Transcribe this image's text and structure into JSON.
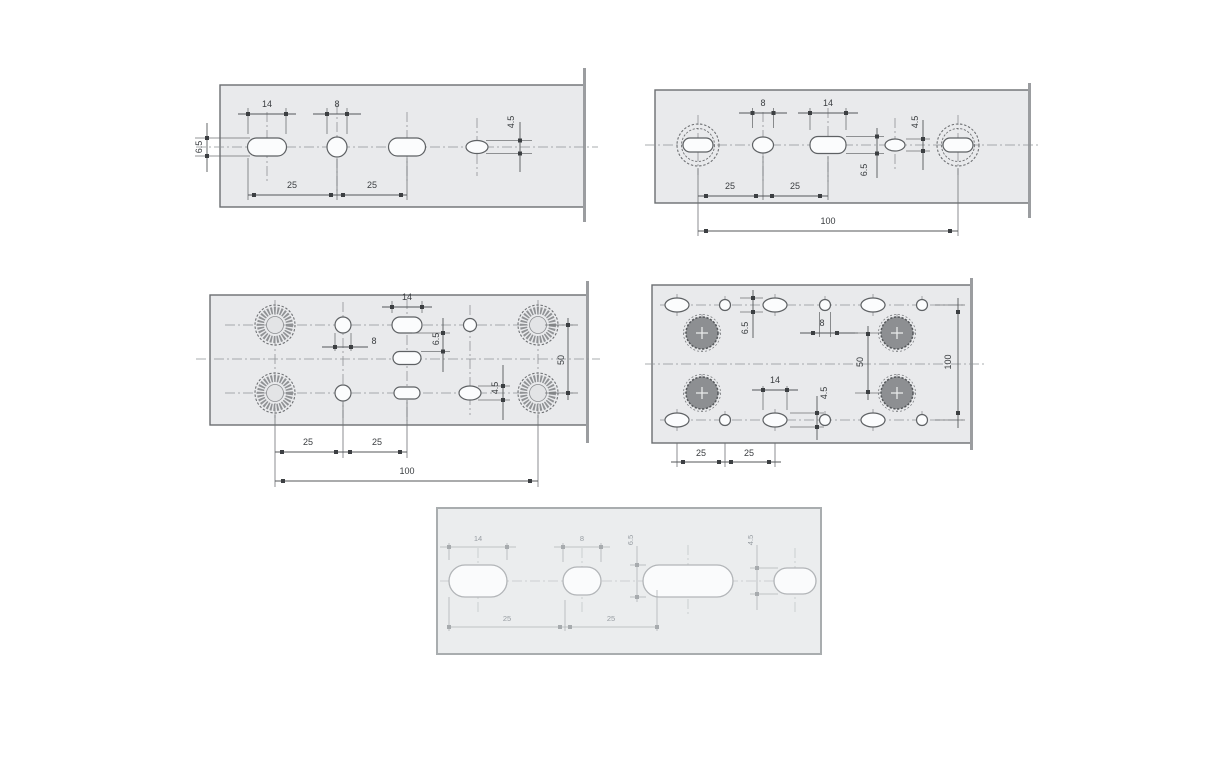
{
  "palette": {
    "plate_fill": "#e9eaec",
    "line_color": "#54575a",
    "faint_line_color": "#b0b3b6",
    "dark_hole_fill": "#8d8f92"
  },
  "drawings": {
    "a": {
      "slot_width": "14",
      "hole_width": "8",
      "slot_height": "6.5",
      "oval_height": "4.5",
      "pitch1": "25",
      "pitch2": "25"
    },
    "b": {
      "hole_width": "8",
      "slot_width": "14",
      "slot_height": "6.5",
      "oval_height": "4.5",
      "pitch1": "25",
      "pitch2": "25",
      "overall_length": "100"
    },
    "c": {
      "slot_width": "14",
      "hole_width": "8",
      "slot_height": "6.5",
      "oval_height": "4.5",
      "row_spacing": "50",
      "pitch1": "25",
      "pitch2": "25",
      "overall_length": "100"
    },
    "d": {
      "slot_height": "6.5",
      "hole_width": "8",
      "row_spacing": "50",
      "slot_width": "14",
      "oval_height": "4.5",
      "overall_height": "100",
      "pitch1": "25",
      "pitch2": "25"
    },
    "e": {
      "slot_width": "14",
      "hole_width": "8",
      "slot_height": "6.5",
      "oval_height": "4.5",
      "pitch1": "25",
      "pitch2": "25"
    }
  }
}
